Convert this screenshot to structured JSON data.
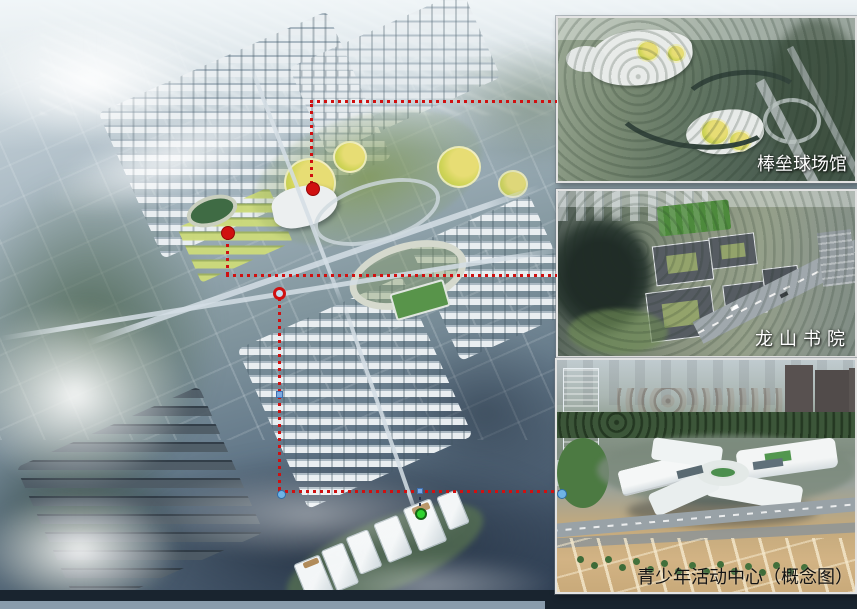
{
  "colors": {
    "leader-red": "#d01010",
    "marker-blue": "#7aa9e2",
    "marker-lightblue": "#6fb3e6",
    "marker-green": "#2fd32f",
    "ring-fill": "#c4def0",
    "label-light": "#ffffff",
    "label-dark": "#141414"
  },
  "insets": [
    {
      "label": "棒垒球场馆"
    },
    {
      "label": "龙山书院"
    },
    {
      "label": "青少年活动中心（概念图）"
    }
  ],
  "markers": [
    {
      "name": "baseball-stadium-site",
      "shape": "filled-circle",
      "color": "#d01010"
    },
    {
      "name": "academy-site",
      "shape": "filled-circle",
      "color": "#d01010"
    },
    {
      "name": "youth-center-site",
      "shape": "ring-circle",
      "color": "#d01010"
    },
    {
      "name": "waypoint-square-1",
      "shape": "square",
      "color": "#7aa9e2"
    },
    {
      "name": "waypoint-dot",
      "shape": "circle",
      "color": "#6fb3e6"
    },
    {
      "name": "waypoint-square-2",
      "shape": "square",
      "color": "#7aa9e2"
    },
    {
      "name": "waterfront-point",
      "shape": "circle",
      "color": "#2fd32f"
    }
  ]
}
